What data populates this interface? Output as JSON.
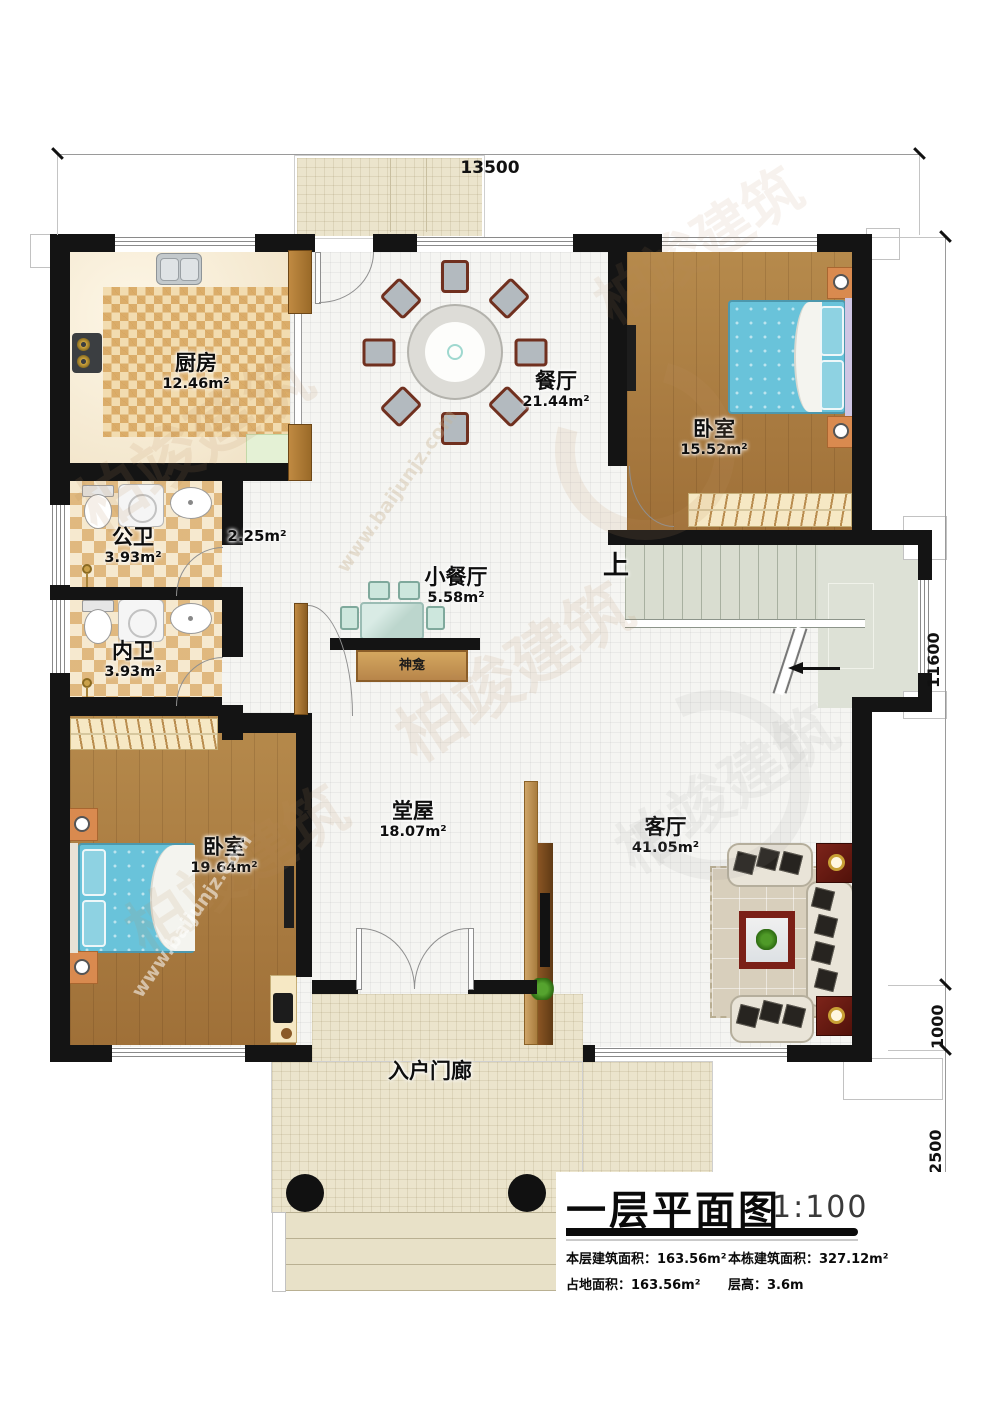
{
  "plan": {
    "rooms": [
      {
        "id": "kitchen",
        "name": "厨房",
        "area": "12.46m²"
      },
      {
        "id": "dining",
        "name": "餐厅",
        "area": "21.44m²"
      },
      {
        "id": "bedroom-top-right",
        "name": "卧室",
        "area": "15.52m²"
      },
      {
        "id": "public-bathroom",
        "name": "公卫",
        "area": "3.93m²"
      },
      {
        "id": "corridor",
        "name": "",
        "area": "2.25m²"
      },
      {
        "id": "small-dining",
        "name": "小餐厅",
        "area": "5.58m²"
      },
      {
        "id": "inner-bathroom",
        "name": "内卫",
        "area": "3.93m²"
      },
      {
        "id": "bedroom-bottom-left",
        "name": "卧室",
        "area": "19.64m²"
      },
      {
        "id": "hall",
        "name": "堂屋",
        "area": "18.07m²"
      },
      {
        "id": "living-room",
        "name": "客厅",
        "area": "41.05m²"
      },
      {
        "id": "entry-porch",
        "name": "入户门廊",
        "area": ""
      }
    ],
    "annotations": {
      "stairs_up": "上",
      "shrine": "神龛"
    },
    "dimensions": {
      "top": "13500",
      "right_building": "11600",
      "right_step1": "1000",
      "right_step2": "2500"
    },
    "title_block": {
      "title": "一层平面图",
      "scale": "1:100",
      "info": [
        {
          "label": "本层建筑面积：",
          "value": "163.56m²"
        },
        {
          "label": "本栋建筑面积：",
          "value": "327.12m²"
        },
        {
          "label": "占地面积：",
          "value": "163.56m²"
        },
        {
          "label": "层高：",
          "value": "3.6m"
        }
      ]
    },
    "watermark": {
      "brand": "柏竣建筑",
      "site": "www.baijunjz.com"
    },
    "colors": {
      "wall": "#141414",
      "wood_floor": "#ab7a3c",
      "mattress_blue": "#69c3da",
      "checker_tan": "#cd913e",
      "tile_white": "#f5f5f2",
      "porch_tile": "#ebe4cc",
      "stair_gray_green": "#d9ddd0",
      "cabinet_wood": "#b5833f",
      "sofa_cream": "#e9e4d8",
      "table_dark_red": "#6e1d12",
      "nightstand_orange": "#d98a4f"
    }
  }
}
